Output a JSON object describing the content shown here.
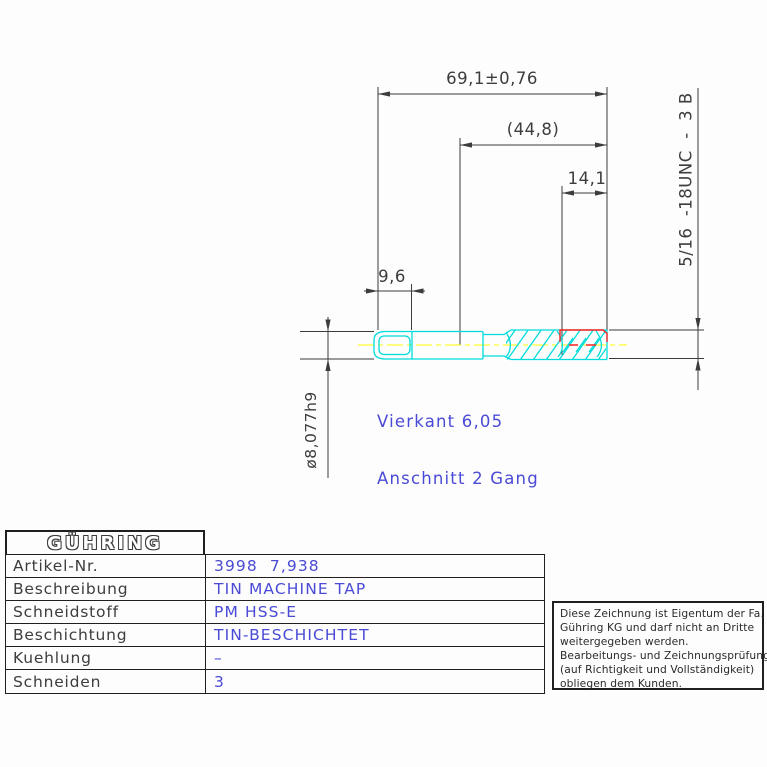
{
  "colors": {
    "accent": "#4a4ad6",
    "dimtext": "#3d3d3d",
    "dim": "#3c3c3c",
    "line": "#1f1f1f",
    "tool": "#00dcdc",
    "center": "#ffff00",
    "red": "#ff2222"
  },
  "drawing": {
    "dimensions": {
      "total_length": "69,1±0,76",
      "ref_length": "(44,8)",
      "thread_length": "14,1",
      "square_length": "9,6",
      "shank_diameter": "ø8,077h9",
      "thread_spec": "5/16  -18UNC  -  3 B"
    },
    "annotations": {
      "line1": "Vierkant 6,05",
      "line2": "Anschnitt 2 Gang"
    }
  },
  "title_block": {
    "brand": "GÜHRING",
    "rows": [
      {
        "label": "Artikel-Nr.",
        "value": "3998  7,938"
      },
      {
        "label": "Beschreibung",
        "value": "TIN MACHINE TAP"
      },
      {
        "label": "Schneidstoff",
        "value": "PM HSS-E"
      },
      {
        "label": "Beschichtung",
        "value": "TIN-BESCHICHTET"
      },
      {
        "label": "Kuehlung",
        "value": "–"
      },
      {
        "label": "Schneiden",
        "value": "3"
      }
    ]
  },
  "disclaimer": {
    "lines": [
      "Diese Zeichnung ist Eigentum der Fa.",
      "Gühring KG und darf nicht an Dritte",
      "weitergegeben werden.",
      "Bearbeitungs- und Zeichnungsprüfung",
      "(auf Richtigkeit und Vollständigkeit)",
      "obliegen dem Kunden."
    ]
  }
}
